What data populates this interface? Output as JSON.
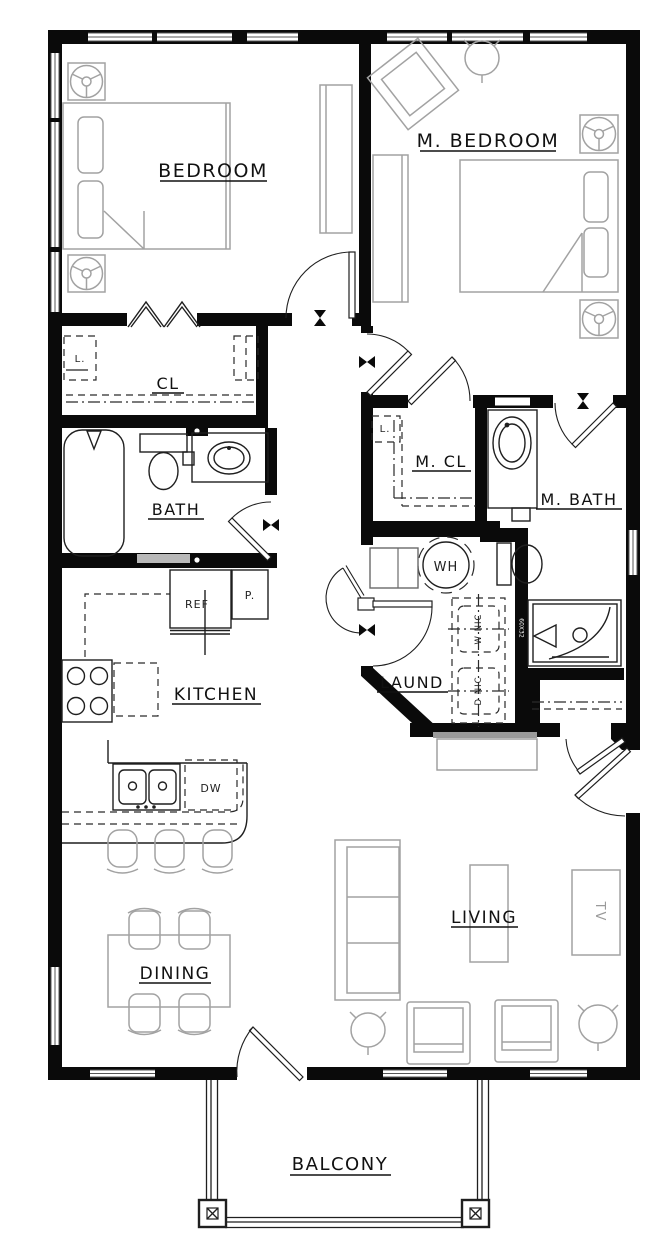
{
  "plan_title": "Apartment floor plan",
  "colors": {
    "wall": "#0a0a0a",
    "fixture_line": "#1f1f1f",
    "furniture_line": "#a2a2a2",
    "background": "#ffffff"
  },
  "rooms": {
    "bedroom": "BEDROOM",
    "master_bedroom": "M. BEDROOM",
    "closet": "CL",
    "bath": "BATH",
    "master_closet": "M. CL",
    "master_bath": "M. BATH",
    "kitchen": "KITCHEN",
    "laundry": "LAUND",
    "dining": "DINING",
    "living": "LIVING",
    "balcony": "BALCONY"
  },
  "fixtures": {
    "water_heater": "WH",
    "refrigerator": "REF",
    "pantry": "P.",
    "dishwasher": "DW",
    "tv": "TV",
    "washer": "W NIC",
    "dryer": "D NIC",
    "linen_a": "L.",
    "linen_b": "L.",
    "shower_tag": "60X32"
  }
}
